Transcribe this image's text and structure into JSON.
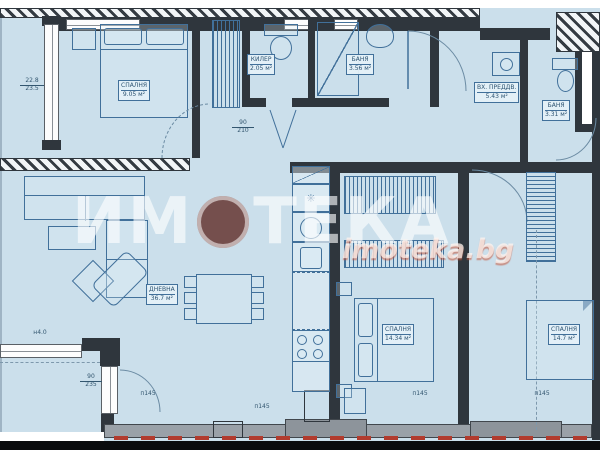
{
  "watermark": {
    "part1": "ИМ",
    "part2": "ТЕКА",
    "site": "imoteka.bg"
  },
  "rooms": {
    "bedroom1": {
      "name": "СПАЛНЯ",
      "area": "9.05 м²"
    },
    "closet": {
      "name": "КИЛЕР",
      "area": "2.05 м²"
    },
    "bath1": {
      "name": "БАНЯ",
      "area": "3.56 м²"
    },
    "entry": {
      "name": "ВХ. ПРЕДДВ.",
      "area": "5.43 м²"
    },
    "bath2": {
      "name": "БАНЯ",
      "area": "3.31 м²"
    },
    "living": {
      "name": "ДНЕВНА",
      "area": "36.7 м²"
    },
    "bedroom2": {
      "name": "СПАЛНЯ",
      "area": "14.34 м²"
    },
    "bedroom3": {
      "name": "СПАЛНЯ",
      "area": "14.7 м²"
    }
  },
  "dims": {
    "left1": "22.8",
    "left2": "23.5",
    "door1": "90",
    "door2": "210",
    "balc1": "90",
    "balc2": "235",
    "len": "н4.0",
    "b1": "п145",
    "b2": "п145",
    "b3": "п145",
    "b4": "п145"
  },
  "icons": {
    "stove_symbol": "✳"
  }
}
